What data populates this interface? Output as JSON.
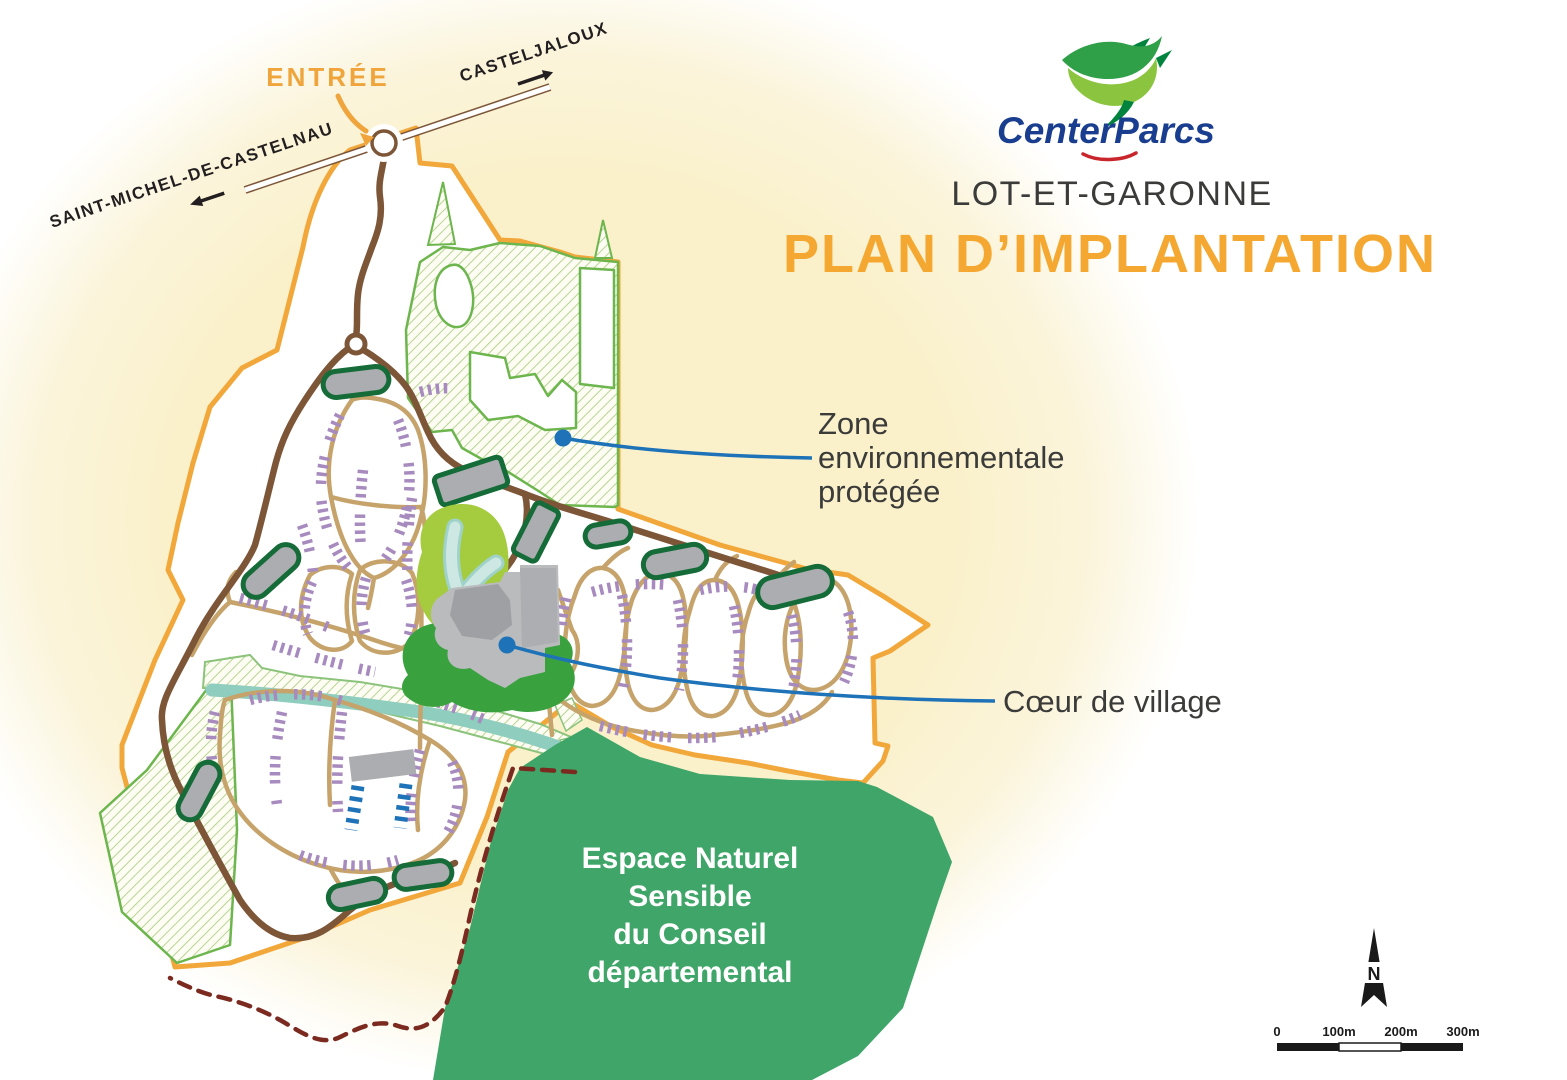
{
  "header": {
    "brand": "CenterParcs",
    "region": "LOT-ET-GARONNE",
    "title": "PLAN D’IMPLANTATION"
  },
  "map": {
    "entrance_label": "ENTRÉE",
    "road_destination_right": "CASTELJALOUX",
    "road_destination_left": "SAINT-MICHEL-DE-CASTELNAU",
    "annotations": {
      "protected_zone": {
        "lines": [
          "Zone",
          "environnementale",
          "protégée"
        ]
      },
      "village_heart": {
        "label": "Cœur de village"
      },
      "natural_space": {
        "lines": [
          "Espace Naturel",
          "Sensible",
          "du Conseil",
          "départemental"
        ]
      }
    }
  },
  "compass": {
    "north_label": "N"
  },
  "scale_bar": {
    "ticks": [
      "0",
      "100m",
      "200m",
      "300m"
    ]
  },
  "colors": {
    "site_boundary_orange": "#F2A73B",
    "main_road_brown": "#7D5638",
    "secondary_road_tan": "#C6A36B",
    "cottages_purple": "#A78BBE",
    "special_lodges_blue": "#1D72B8",
    "parking_fill_gray": "#ABADB0",
    "parking_border_green": "#156C38",
    "protected_hatch_green": "#6DB54D",
    "ens_green": "#3FA569",
    "river_teal": "#8FCDBF",
    "water_blue": "#BFE0DB",
    "village_gray": "#B9BBBD",
    "village_green": "#39A23F",
    "leisure_green": "#A5CB3F",
    "label_dark": "#3B3B3A",
    "accent_orange": "#F5A831",
    "annotation_blue": "#1D72B8",
    "dashed_limit_maroon": "#7B2A20",
    "halo_cream": "#FAF1CB",
    "logo_navy": "#1A3E8F",
    "logo_red": "#C9252C",
    "logo_green": "#2FA048"
  }
}
